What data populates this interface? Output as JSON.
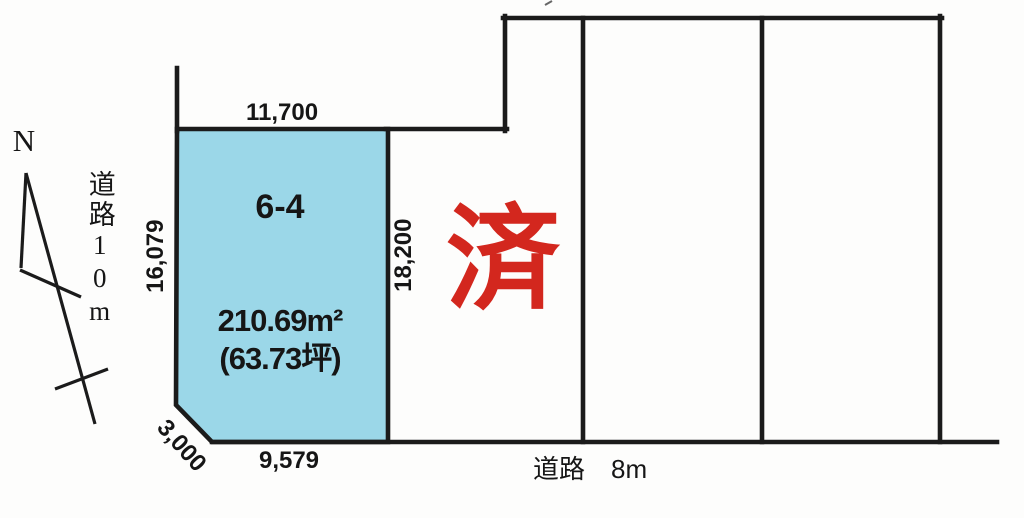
{
  "compass": {
    "north_label": "N"
  },
  "roads": {
    "west_label": "道路10m",
    "south_label": "道路　8m"
  },
  "plot": {
    "id": "6-4",
    "area_m2": "210.69m²",
    "area_tsubo": "(63.73坪)",
    "dim_top": "11,700",
    "dim_left": "16,079",
    "dim_right": "18,200",
    "dim_bottom": "9,579",
    "dim_corner": "3,000"
  },
  "stamp": {
    "label": "済"
  },
  "colors": {
    "plot_fill": "#9bd7e8",
    "line": "#1b1b1b",
    "stamp_red": "#d3271e",
    "text": "#161616"
  }
}
